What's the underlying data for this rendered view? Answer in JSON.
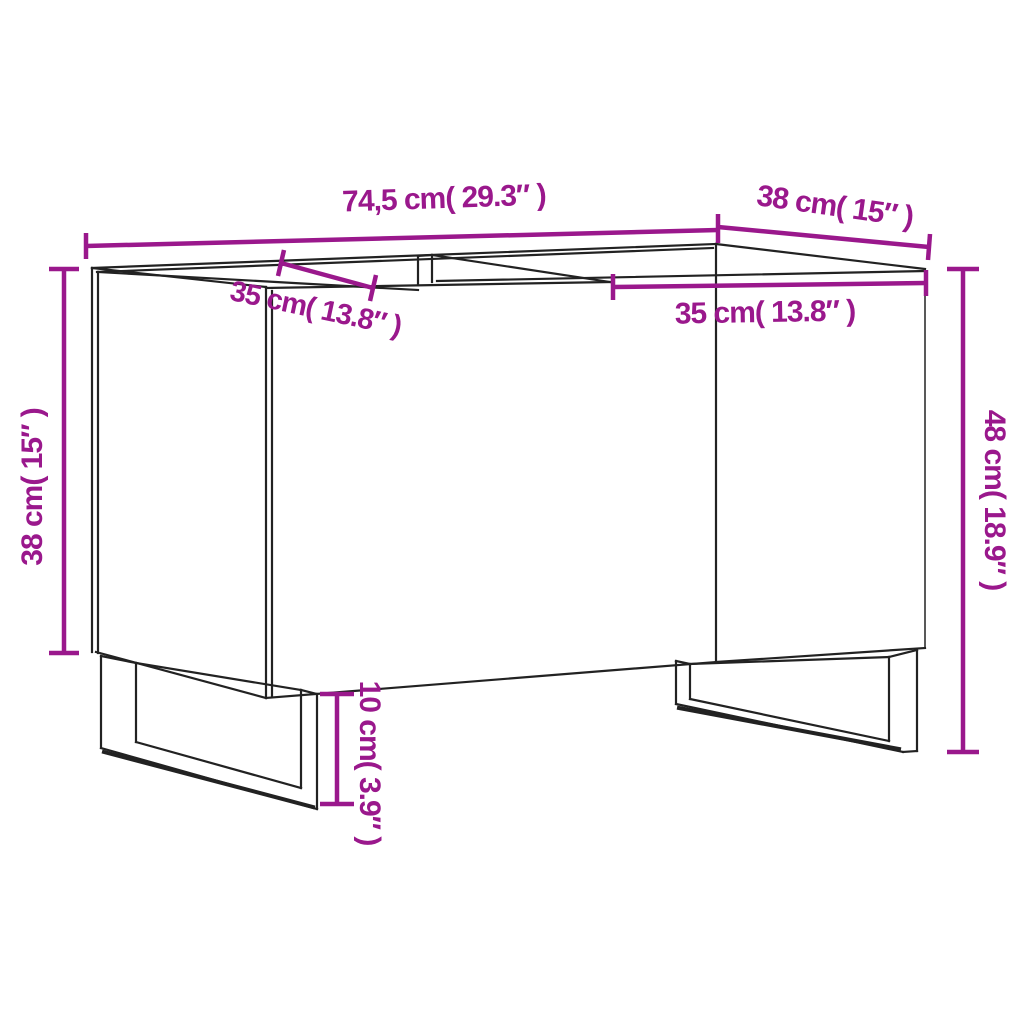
{
  "colors": {
    "accent": "#9A188C",
    "line": "#222222",
    "background": "#FFFFFF"
  },
  "dimensions": {
    "top_width": "74,5 cm( 29.3″ )",
    "depth": "38 cm( 15″ )",
    "left_compartment": "35 cm( 13.8″ )",
    "right_compartment": "35 cm( 13.8″ )",
    "carcass_height": "38 cm( 15″ )",
    "total_height": "48 cm( 18.9″ )",
    "leg_height": "10 cm( 3.9″ )"
  }
}
